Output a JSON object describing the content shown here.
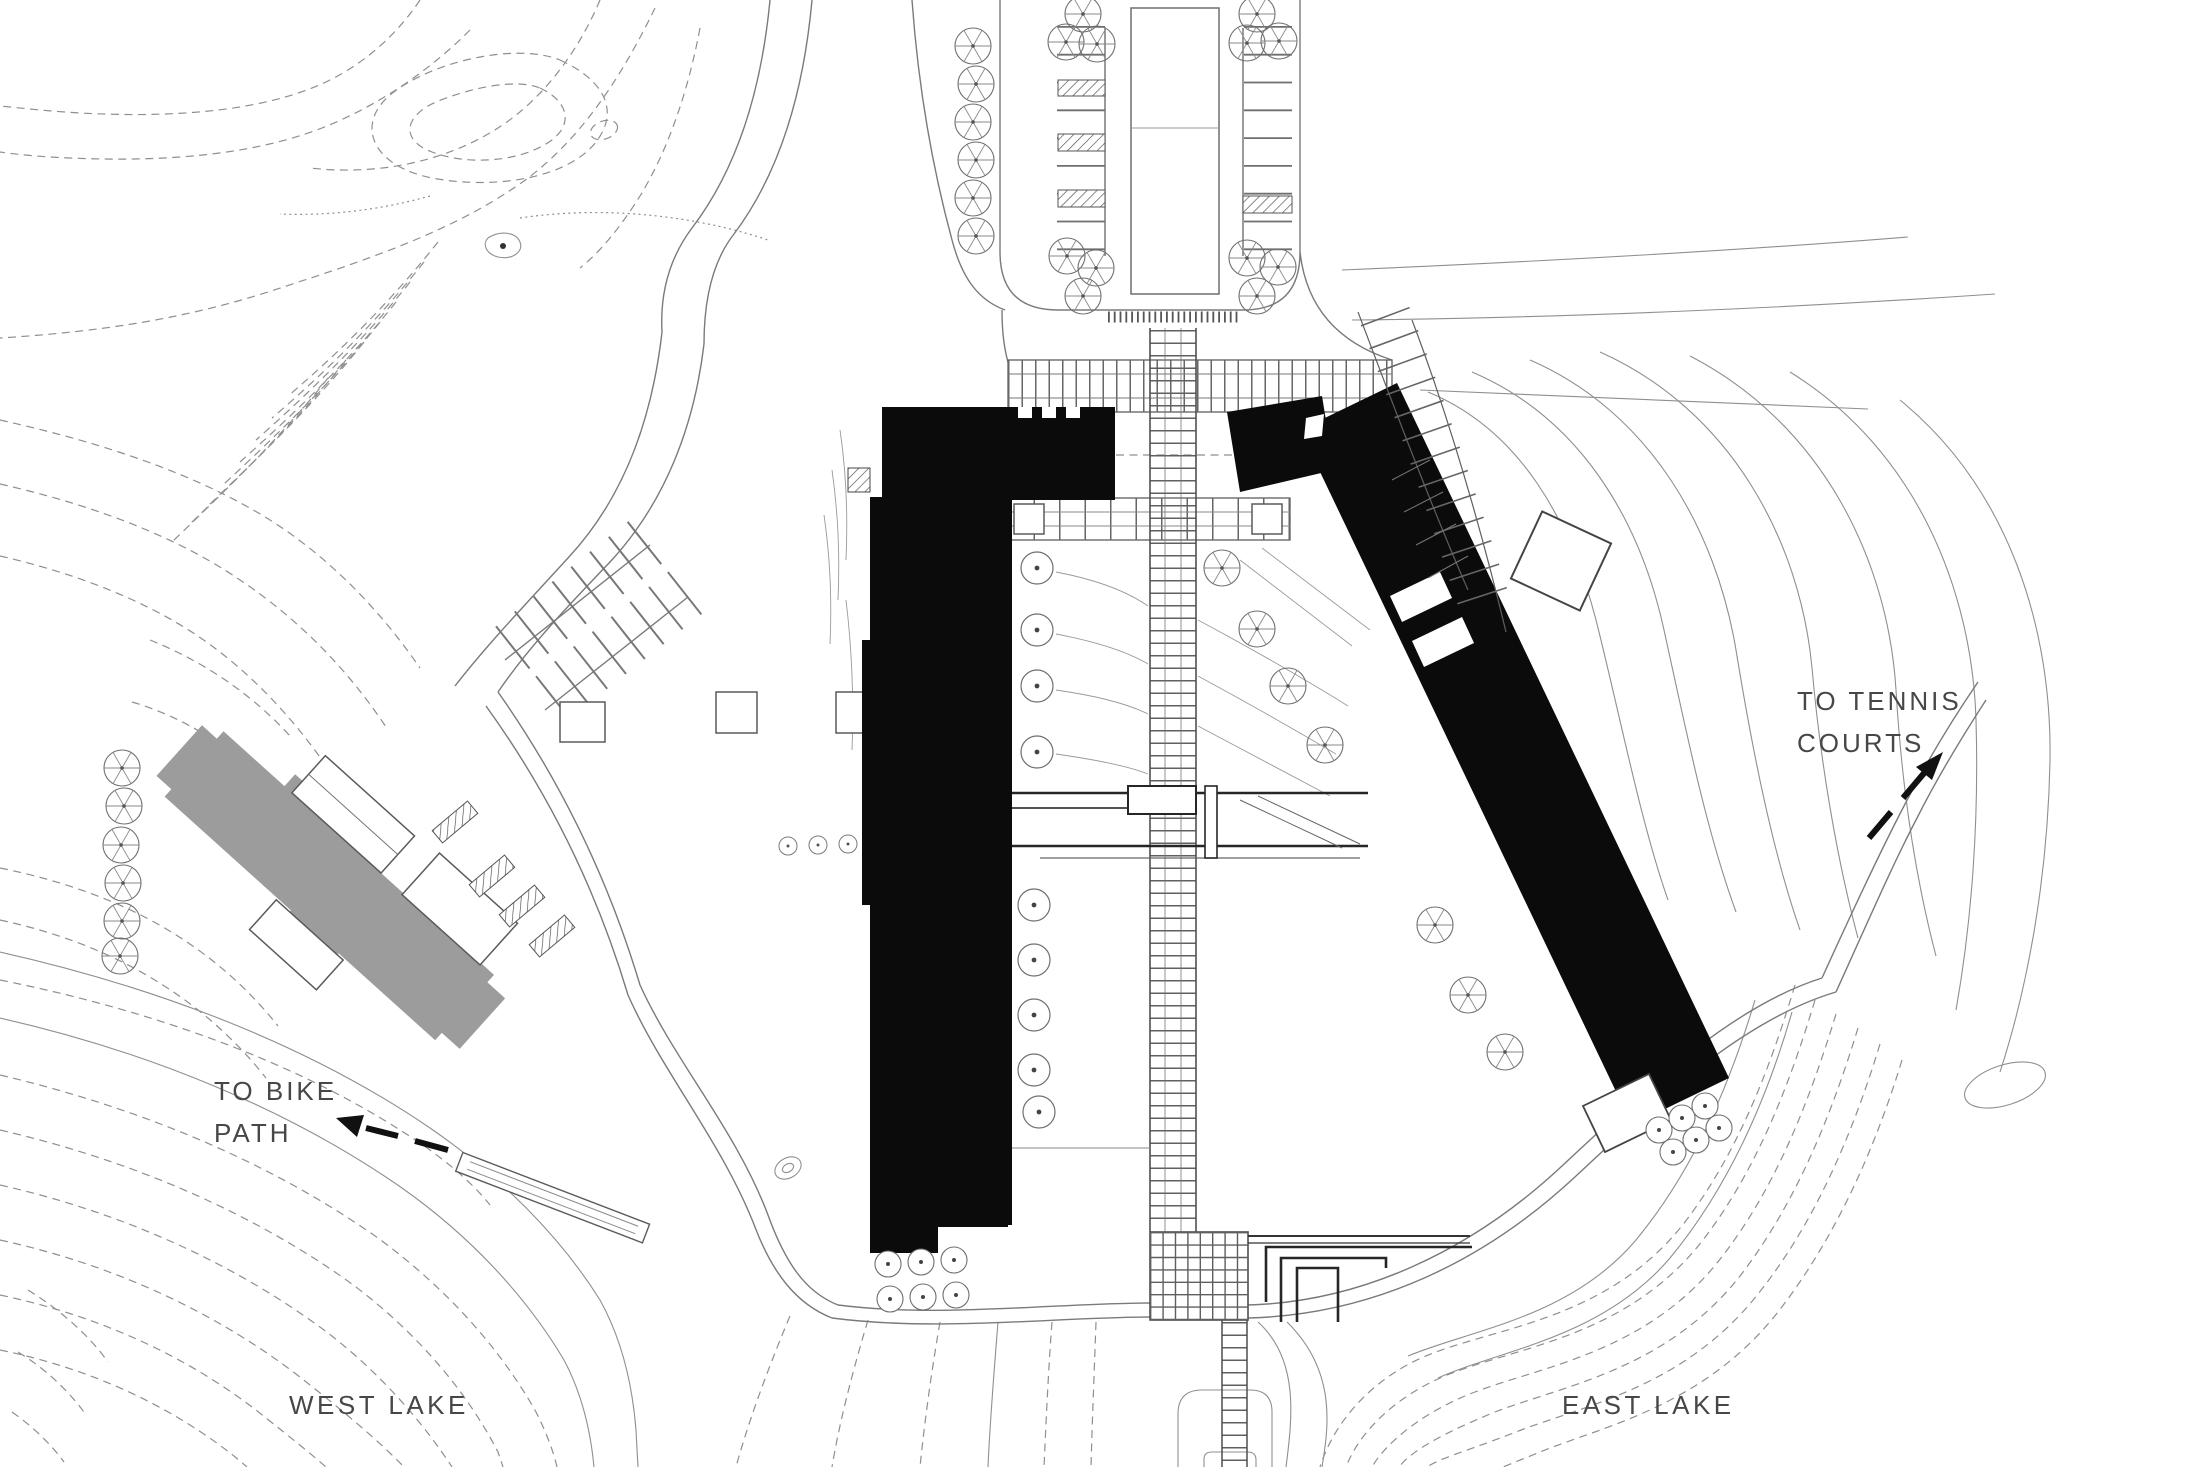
{
  "plan": {
    "type": "architectural-site-plan",
    "labels": {
      "west_lake": "WEST LAKE",
      "east_lake": "EAST LAKE",
      "tennis_line1": "TO TENNIS",
      "tennis_line2": "COURTS",
      "bike_line1": "TO BIKE",
      "bike_line2": "PATH"
    },
    "icons": {
      "tennis_arrow": "arrow-up-right",
      "bike_arrow": "arrow-left"
    },
    "colors": {
      "background": "#ffffff",
      "proposed_building": "#0b0b0b",
      "existing_building": "#9c9c9c",
      "contour_line": "#8f8f8f",
      "label_text": "#474747"
    }
  }
}
